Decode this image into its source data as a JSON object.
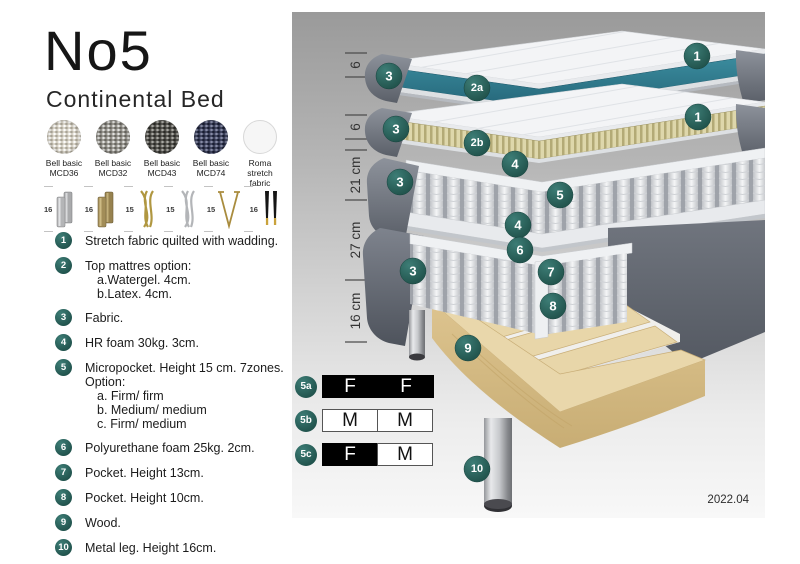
{
  "header": {
    "title": "No5",
    "subtitle": "Continental Bed"
  },
  "swatches": [
    {
      "line1": "Bell basic",
      "line2": "MCD36"
    },
    {
      "line1": "Bell basic",
      "line2": "MCD32"
    },
    {
      "line1": "Bell basic",
      "line2": "MCD43"
    },
    {
      "line1": "Bell basic",
      "line2": "MCD74"
    },
    {
      "line1": "Roma",
      "line2": "stretch fabric"
    }
  ],
  "legs": [
    {
      "size": "16",
      "icon": "leg-cylinder-silver"
    },
    {
      "size": "16",
      "icon": "leg-cylinder-brass"
    },
    {
      "size": "15",
      "icon": "leg-twist-gold"
    },
    {
      "size": "15",
      "icon": "leg-twist-silver"
    },
    {
      "size": "15",
      "icon": "leg-hairpin-gold"
    },
    {
      "size": "16",
      "icon": "leg-taper-black-gold"
    }
  ],
  "features": [
    {
      "num": "1",
      "text": "Stretch fabric quilted with wadding."
    },
    {
      "num": "2",
      "text": "Top mattres option:",
      "sub": [
        "a.Watergel. 4cm.",
        "b.Latex. 4cm."
      ]
    },
    {
      "num": "3",
      "text": "Fabric."
    },
    {
      "num": "4",
      "text": "HR foam 30kg. 3cm."
    },
    {
      "num": "5",
      "text": "Micropocket. Height 15 cm. 7zones. Option:",
      "sub": [
        "a. Firm/ firm",
        "b. Medium/ medium",
        "c. Firm/ medium"
      ]
    },
    {
      "num": "6",
      "text": "Polyurethane foam 25kg. 2cm."
    },
    {
      "num": "7",
      "text": "Pocket. Height 13cm."
    },
    {
      "num": "8",
      "text": "Pocket. Height 10cm."
    },
    {
      "num": "9",
      "text": "Wood."
    },
    {
      "num": "10",
      "text": "Metal leg. Height 16cm."
    }
  ],
  "diagram": {
    "measurements": [
      "6",
      "6",
      "21 cm",
      "27 cm",
      "16 cm"
    ],
    "badges": {
      "top_fabric": "3",
      "watergel": "2a",
      "top_quilt": "1",
      "mid_fabric": "3",
      "latex": "2b",
      "mid_quilt": "1",
      "hr_foam_top": "4",
      "core_fabric": "3",
      "micropocket": "5",
      "hr_foam_bottom": "4",
      "pu_foam": "6",
      "base_fabric": "3",
      "pocket_13": "7",
      "pocket_10": "8",
      "wood": "9",
      "metal_leg": "10"
    }
  },
  "firmness": {
    "rows": [
      {
        "label": "5a",
        "cells": [
          {
            "letter": "F"
          },
          {
            "letter": "F"
          }
        ]
      },
      {
        "label": "5b",
        "cells": [
          {
            "letter": "M"
          },
          {
            "letter": "M"
          }
        ]
      },
      {
        "label": "5c",
        "cells": [
          {
            "letter": "F"
          },
          {
            "letter": "M"
          }
        ]
      }
    ]
  },
  "version": "2022.04",
  "colors": {
    "badge_teal": "#2E6E68",
    "watergel_teal": "#2F7F90",
    "latex": "#D9D3AB",
    "fabric_gray": "#6B707A",
    "wood": "#E3D0A2"
  }
}
